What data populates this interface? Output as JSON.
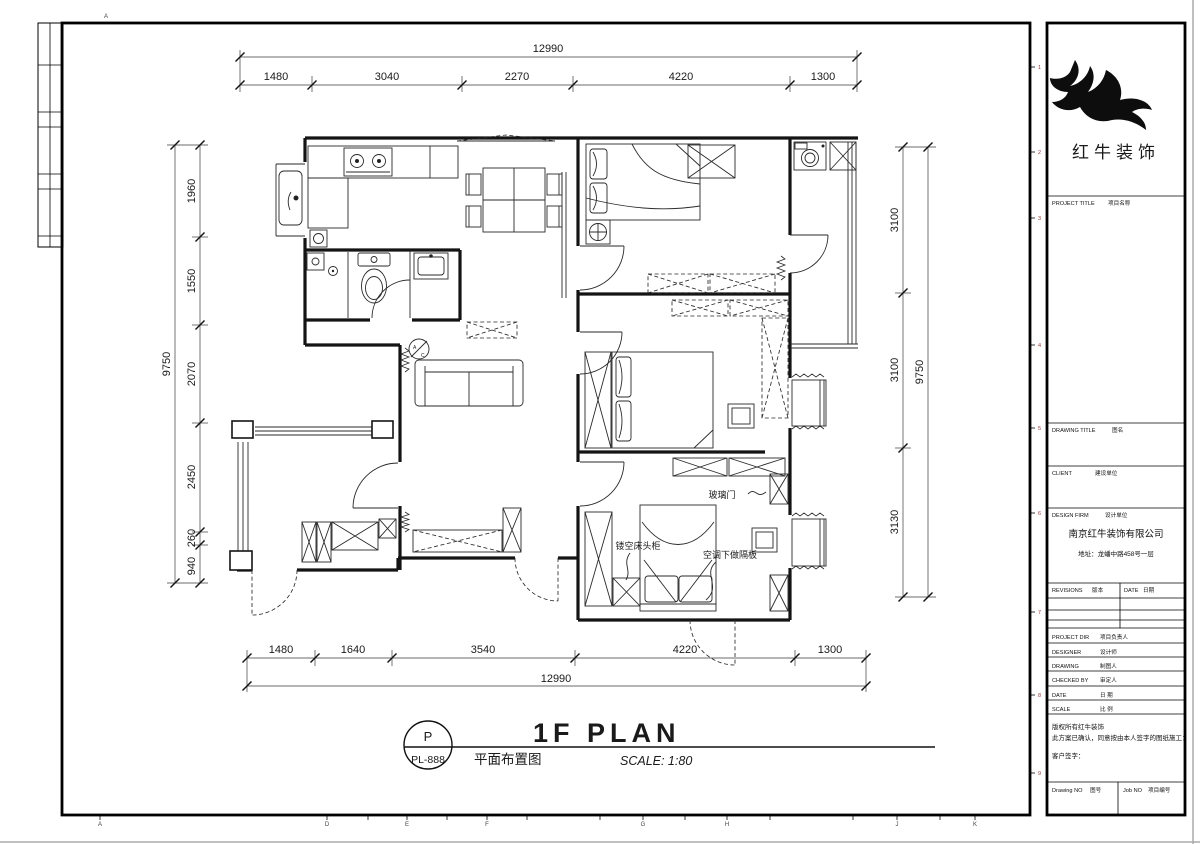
{
  "sheet": {
    "brand": "红牛装饰",
    "grid_letter_top": "A",
    "grid_letters_bottom": [
      "A",
      "D",
      "E",
      "F",
      "G",
      "H",
      "J",
      "K"
    ],
    "side_numbers": [
      "1",
      "2",
      "3",
      "4",
      "5",
      "6",
      "7",
      "8",
      "9"
    ]
  },
  "title_block": {
    "project_title_en": "PROJECT TITLE",
    "project_title_cn": "项目名称",
    "drawing_title_en": "DRAWING TITLE",
    "drawing_title_cn": "图名",
    "client_en": "CLIENT",
    "client_cn": "建设单位",
    "design_firm_en": "DESIGN FIRM",
    "design_firm_cn": "设计单位",
    "firm_name": "南京红牛装饰有限公司",
    "firm_address": "地址：龙蟠中路458号一层",
    "revisions_en": "REVISIONS",
    "revisions_cn": "版本",
    "date_col_en": "DATE",
    "date_col_cn": "日期",
    "project_dir_en": "PROJECT DIR",
    "project_dir_cn": "项目负责人",
    "designer_en": "DESIGNER",
    "designer_cn": "设计师",
    "drawing_en": "DRAWING",
    "drawing_cn": "制图人",
    "checked_by_en": "CHECKED BY",
    "checked_by_cn": "审定人",
    "date_en": "DATE",
    "date_cn": "日 期",
    "scale_en": "SCALE",
    "scale_cn": "比 例",
    "copyright_line1": "版权所有红牛装饰",
    "copyright_line2": "此方案已确认，同意按由本人签字的图纸施工：",
    "client_sign": "客户签字：",
    "drawing_no_en": "Drawing NO",
    "drawing_no_cn": "图号",
    "job_no_en": "Job NO",
    "job_no_cn": "项目编号"
  },
  "title_bar": {
    "stamp_letter": "P",
    "stamp_code": "PL-888",
    "plan_title_en": "1F PLAN",
    "plan_title_cn": "平面布置图",
    "scale_text": "SCALE: 1:80"
  },
  "dimensions": {
    "top": {
      "overall": "12990",
      "segments": [
        "1480",
        "3040",
        "2270",
        "4220",
        "1300"
      ]
    },
    "bottom": {
      "overall": "12990",
      "segments": [
        "1480",
        "1640",
        "3540",
        "4220",
        "1300"
      ]
    },
    "left": {
      "overall": "9750",
      "segments": [
        "1960",
        "1550",
        "2070",
        "2450",
        "260",
        "940"
      ]
    },
    "right": {
      "overall": "9750",
      "segments": [
        "3100",
        "3100",
        "3130"
      ]
    }
  },
  "plan_labels": {
    "glass_door": "玻璃门",
    "floating_nightstand": "镂空床头柜",
    "ac_shelf": "空调下做隔板",
    "ac_a": "A",
    "ac_c": "C"
  }
}
